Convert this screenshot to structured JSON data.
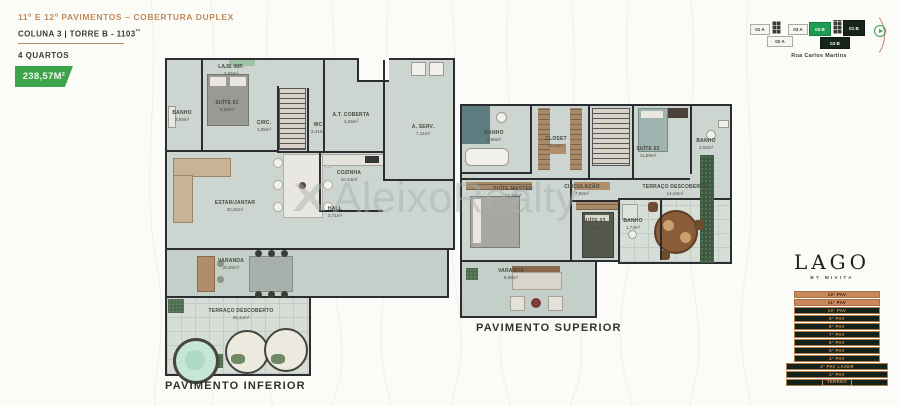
{
  "header": {
    "title": "11º E 12º PAVIMENTOS – COBERTURA DUPLEX",
    "subtitle": "COLUNA 3 | TORRE B - 1103",
    "subtitle_sup": "**",
    "bedrooms": "4 QUARTOS",
    "area_badge": "238,57M²"
  },
  "unit_selector": {
    "street": "Rua Carlos Martins",
    "units": [
      {
        "label": "01 A",
        "state": "light"
      },
      {
        "label": "03 A",
        "state": "light"
      },
      {
        "label": "03 B",
        "state": "selected"
      },
      {
        "label": "01 B",
        "state": "dark"
      },
      {
        "label": "02 A",
        "state": "light"
      },
      {
        "label": "02 B",
        "state": "dark"
      }
    ]
  },
  "watermark": {
    "text": "AleixoRealty",
    "mark": "X"
  },
  "logo": {
    "name": "LAGO",
    "sub": "BY MIVITA"
  },
  "floor_stack": [
    {
      "label": "12º PAV",
      "highlight": true
    },
    {
      "label": "11º PAV",
      "highlight": true
    },
    {
      "label": "10º PAV",
      "highlight": false
    },
    {
      "label": "9º PAV",
      "highlight": false
    },
    {
      "label": "8º PAV",
      "highlight": false
    },
    {
      "label": "7º PAV",
      "highlight": false
    },
    {
      "label": "6º PAV",
      "highlight": false
    },
    {
      "label": "5º PAV",
      "highlight": false
    },
    {
      "label": "4º PAV",
      "highlight": false
    },
    {
      "label": "3º PAV LAZER",
      "highlight": false
    },
    {
      "label": "2º PAV",
      "highlight": false
    },
    {
      "label": "TÉRREO",
      "highlight": false
    }
  ],
  "plans": {
    "inferior": {
      "caption": "PAVIMENTO INFERIOR",
      "rooms": [
        {
          "name": "LAJE IMP.",
          "area": "3,05m²"
        },
        {
          "name": "BANHO",
          "area": "3,59m²"
        },
        {
          "name": "SUÍTE 01",
          "area": "9,55m²"
        },
        {
          "name": "CIRC.",
          "area": "1,95m²"
        },
        {
          "name": "WC",
          "area": "2,41m²"
        },
        {
          "name": "A.T. COBERTA",
          "area": "4,26m²"
        },
        {
          "name": "A. SERV.",
          "area": "7,41m²"
        },
        {
          "name": "COZINHA",
          "area": "10,44m²"
        },
        {
          "name": "ESTAR/JANTAR",
          "area": "32,01m²"
        },
        {
          "name": "HALL",
          "area": "3,71m²"
        },
        {
          "name": "VARANDA",
          "area": "20,82m²"
        },
        {
          "name": "TERRAÇO DESCOBERTO",
          "area": "25,44m²"
        }
      ]
    },
    "superior": {
      "caption": "PAVIMENTO SUPERIOR",
      "rooms": [
        {
          "name": "BANHO",
          "area": "6,99m²"
        },
        {
          "name": "CLOSET",
          "area": "10,52m²"
        },
        {
          "name": "SUÍTE 02",
          "area": "11,59m²"
        },
        {
          "name": "BANHO",
          "area": "3,08m²"
        },
        {
          "name": "SUÍTE MASTER",
          "area": "17,76m²"
        },
        {
          "name": "CIRCULAÇÃO",
          "area": "7,59m²"
        },
        {
          "name": "SUÍTE 03",
          "area": "13,56m²"
        },
        {
          "name": "BANHO",
          "area": "1,74m²"
        },
        {
          "name": "TERRAÇO DESCOBERTO",
          "area": "14,04m²"
        },
        {
          "name": "VARANDA",
          "area": "8,56m²"
        }
      ]
    }
  },
  "colors": {
    "accent_tan": "#c08a5b",
    "badge_green": "#3da44a",
    "selected_unit_green": "#1f9b53",
    "stack_dark_green": "#14231a",
    "stack_tan": "#c8885a",
    "plan_floor": "#ccd5d0"
  }
}
